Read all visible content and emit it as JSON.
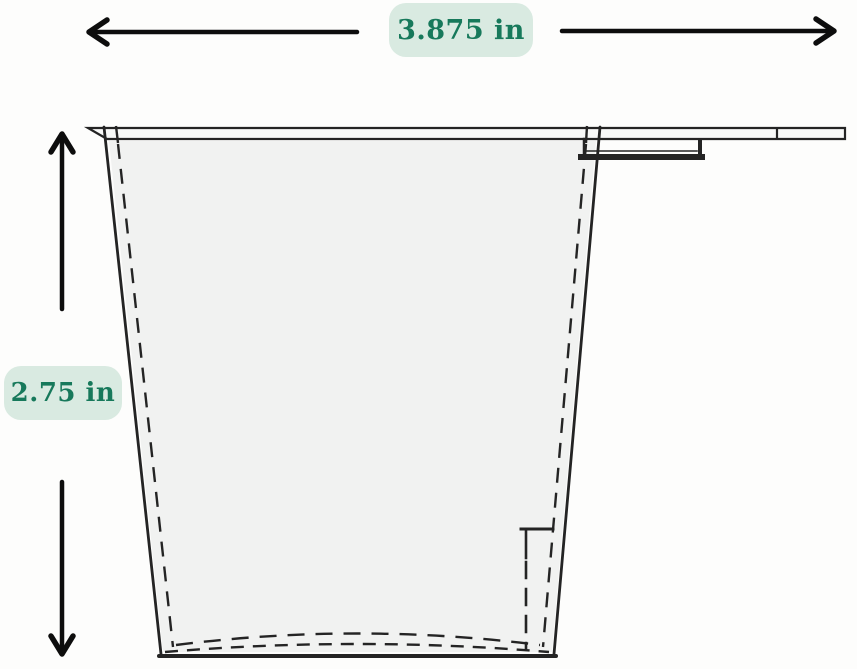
{
  "diagram": {
    "type": "technical-drawing-cross-section",
    "subject": "hanging-cup-with-flange-and-mounting-hook",
    "dimensions": {
      "width_label": "3.875 in",
      "height_label": "2.75 in"
    }
  },
  "colors": {
    "label_bg": "#d9eae1",
    "label_text": "#17795b",
    "line_color": "#242424",
    "arrow_color": "#0d0d0d",
    "interior_fill": "#f1f2f1",
    "page_bg": "#fdfdfc"
  }
}
